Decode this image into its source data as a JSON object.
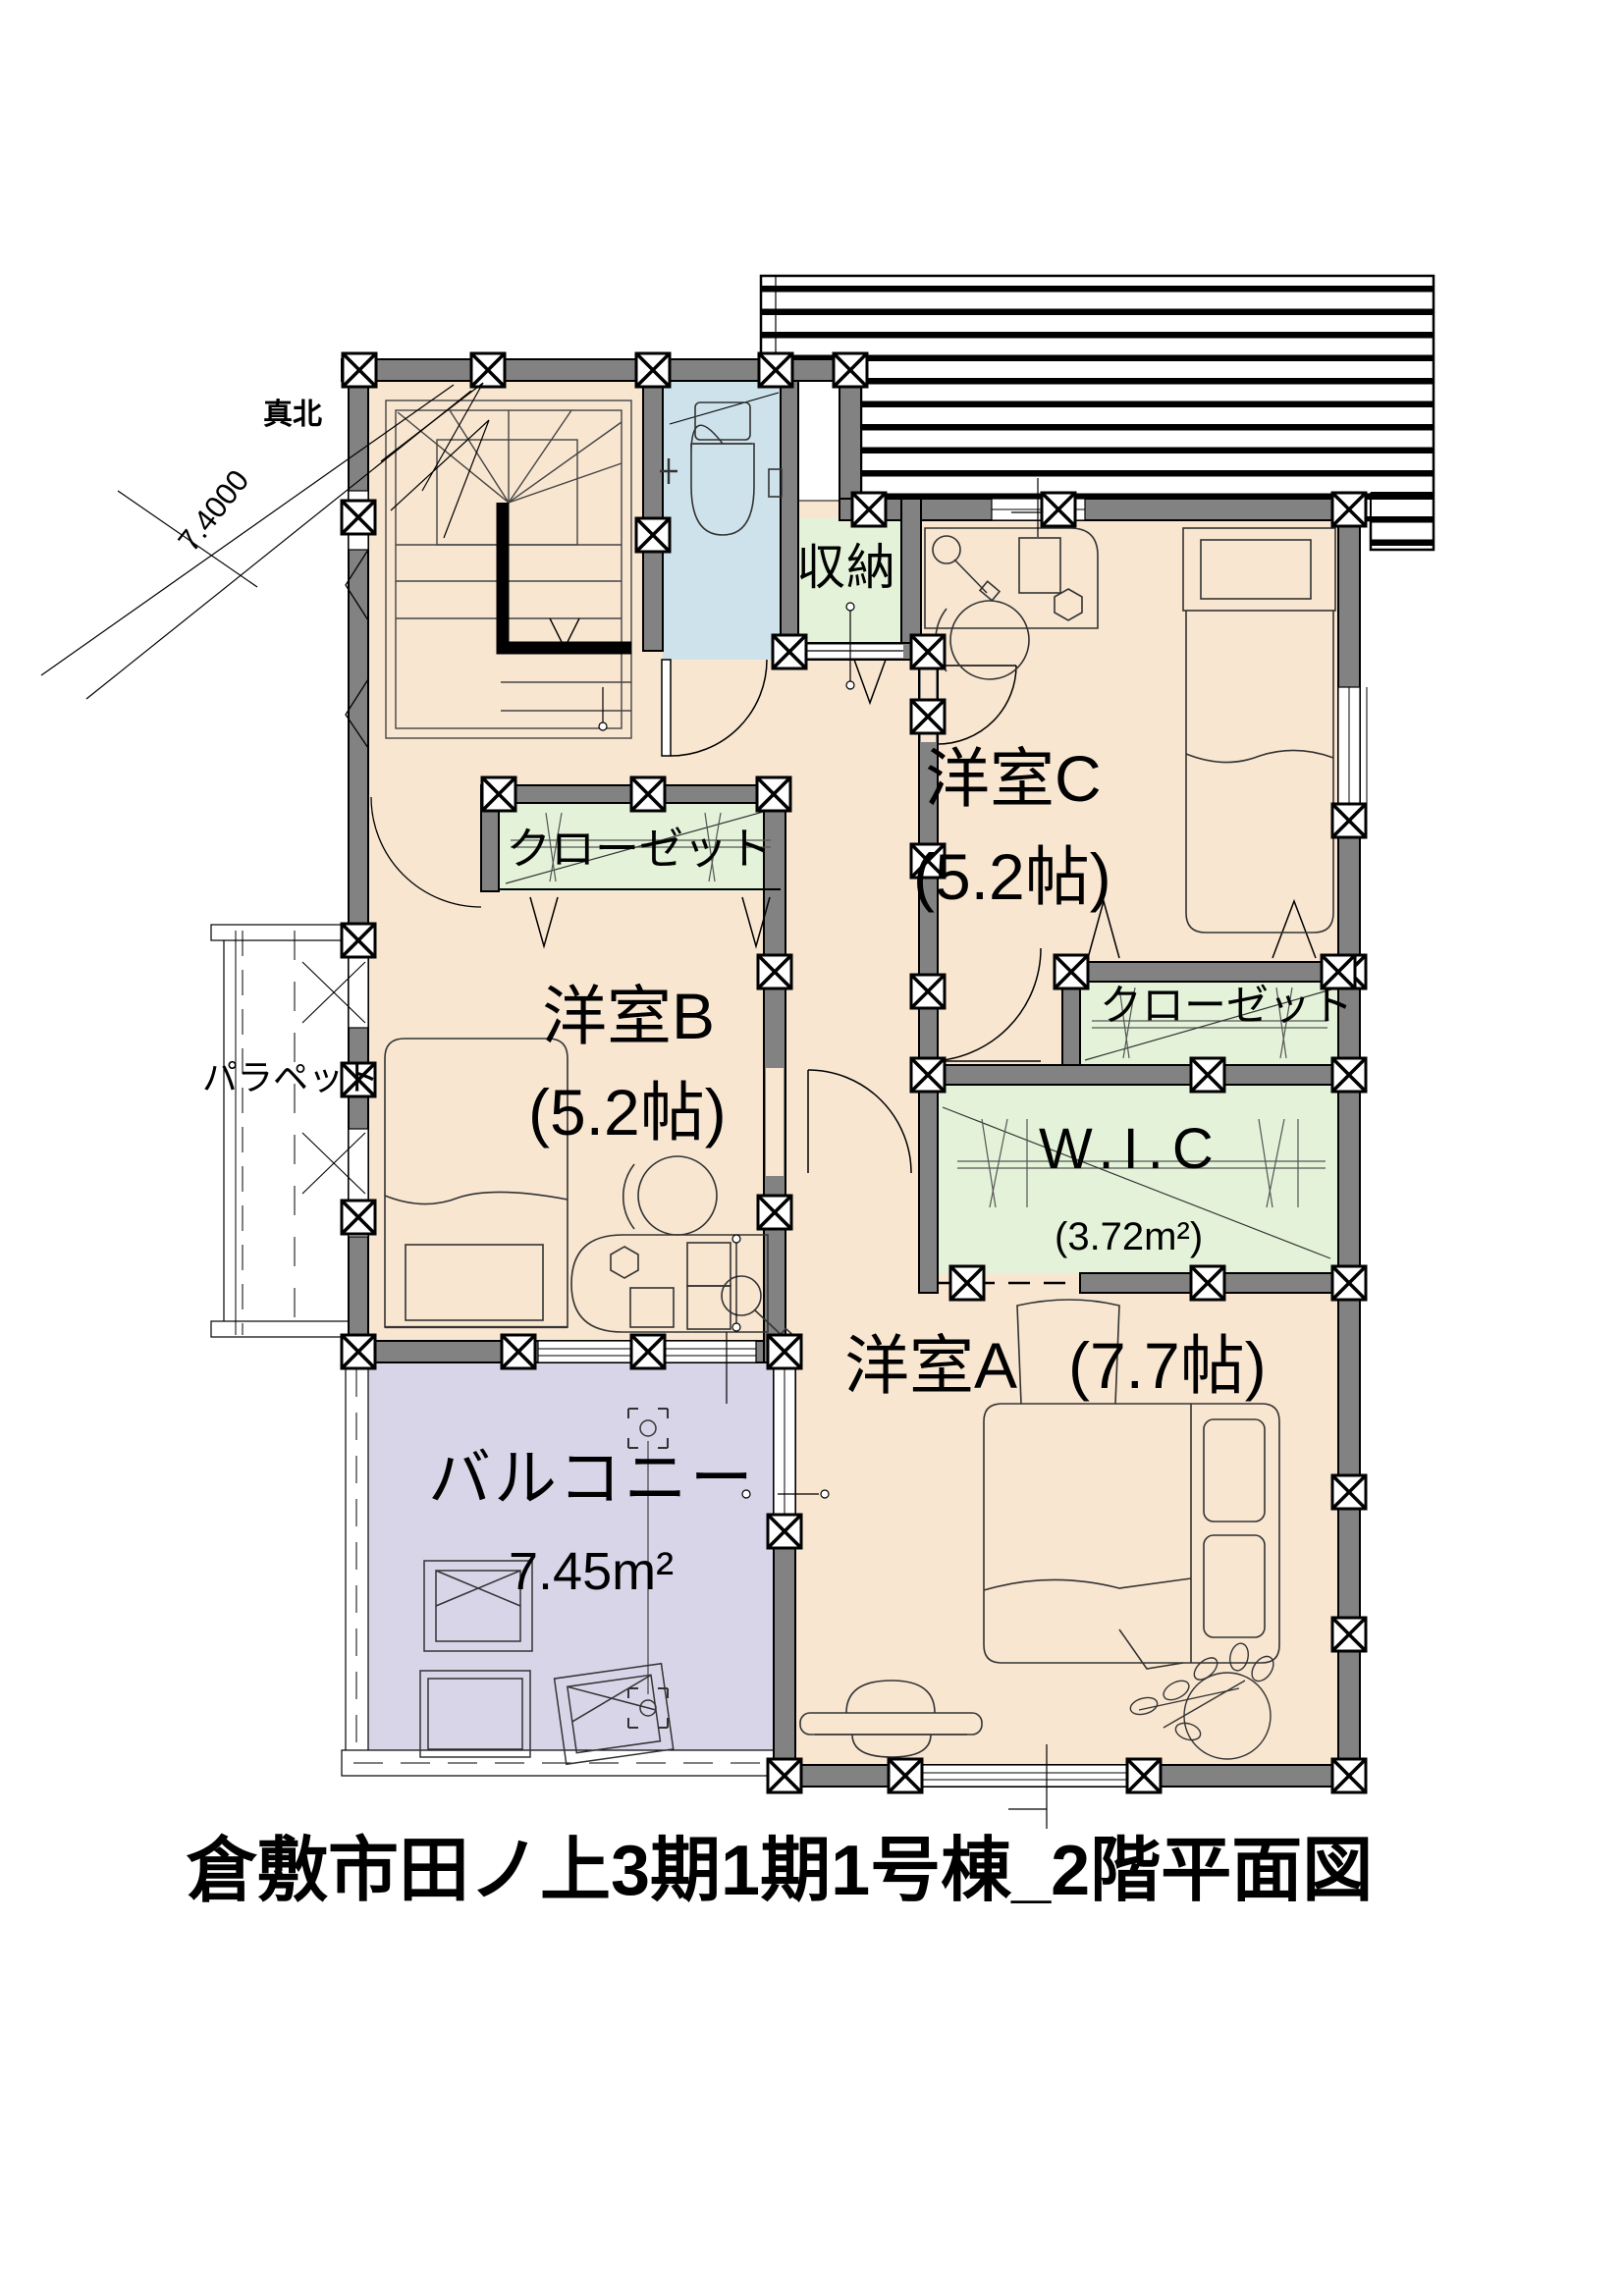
{
  "compass": {
    "north_label": "真北",
    "angle": "7.4000"
  },
  "rooms": {
    "storage": {
      "name": "収納"
    },
    "western_c": {
      "name": "洋室C",
      "size": "(5.2帖)"
    },
    "closet_b": {
      "name": "クローゼット"
    },
    "western_b": {
      "name": "洋室B",
      "size": "(5.2帖)"
    },
    "closet_c": {
      "name": "クローゼット"
    },
    "wic": {
      "name": "W.I.C",
      "size": "(3.72m²)"
    },
    "western_a": {
      "name": "洋室A",
      "size": "(7.7帖)"
    },
    "balcony": {
      "name": "バルコニー",
      "size": "7.45m²"
    },
    "parapet": {
      "name": "パラペット"
    }
  },
  "title": "倉敷市田ノ上3期1期1号棟_2階平面図",
  "colors": {
    "floor_peach": "#f8e6d0",
    "closet_green": "#e3f2d8",
    "toilet_blue": "#cde2ea",
    "balcony_lavender": "#d8d5e9",
    "wall_gray": "#828282",
    "line_black": "#111111"
  }
}
